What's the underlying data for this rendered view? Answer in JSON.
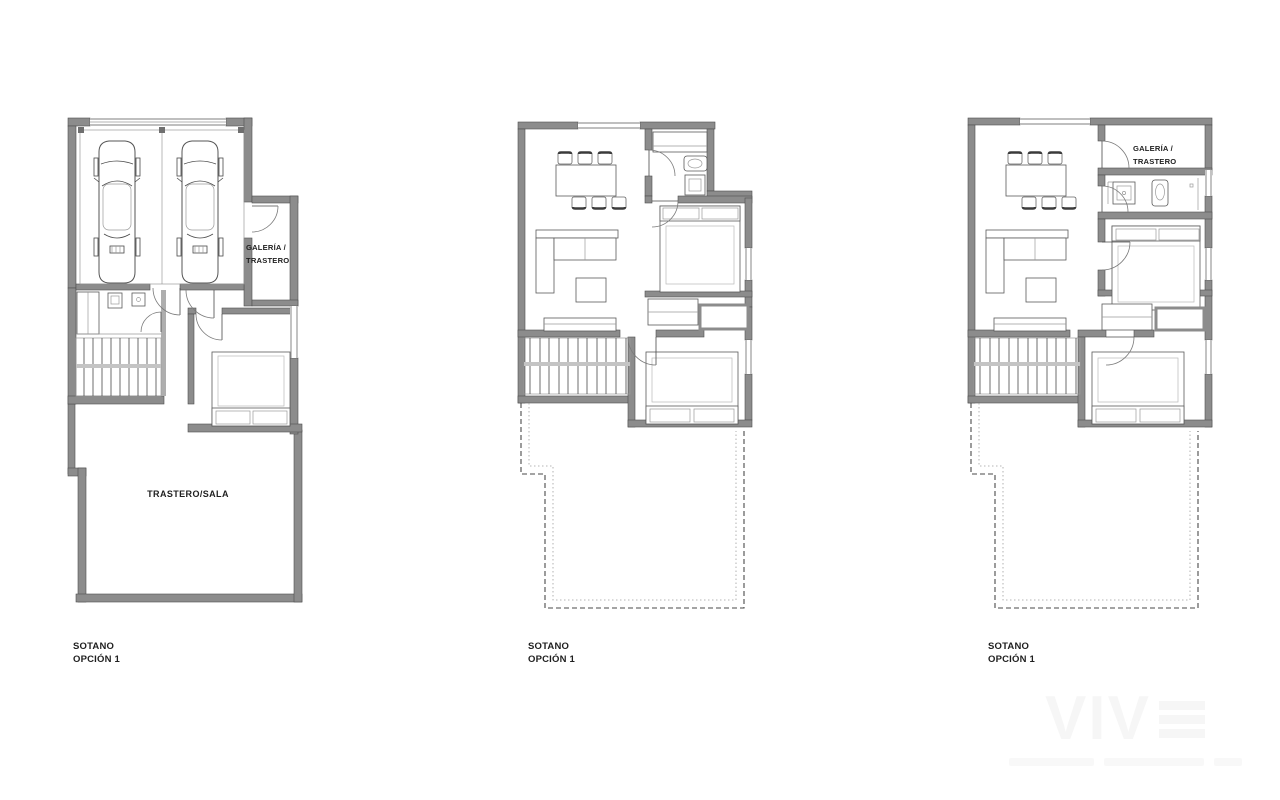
{
  "plans": [
    {
      "name": "sotano-left",
      "caption": [
        "SOTANO",
        "OPCIÓN 1"
      ],
      "labels": {
        "galeria": [
          "GALERÍA /",
          "TRASTERO"
        ],
        "sala": "TRASTERO/SALA"
      }
    },
    {
      "name": "sotano-middle",
      "caption": [
        "SOTANO",
        "OPCIÓN 1"
      ]
    },
    {
      "name": "sotano-right",
      "caption": [
        "SOTANO",
        "OPCIÓN 1"
      ],
      "labels": {
        "galeria": [
          "GALERÍA /",
          "TRASTERO"
        ]
      }
    }
  ],
  "watermark": "VIV",
  "colors": {
    "wall": "#8c8c8c",
    "wall_edge": "#4f4f4f",
    "line": "#4a4a4a",
    "text": "#1f1f1f",
    "background": "#ffffff"
  }
}
